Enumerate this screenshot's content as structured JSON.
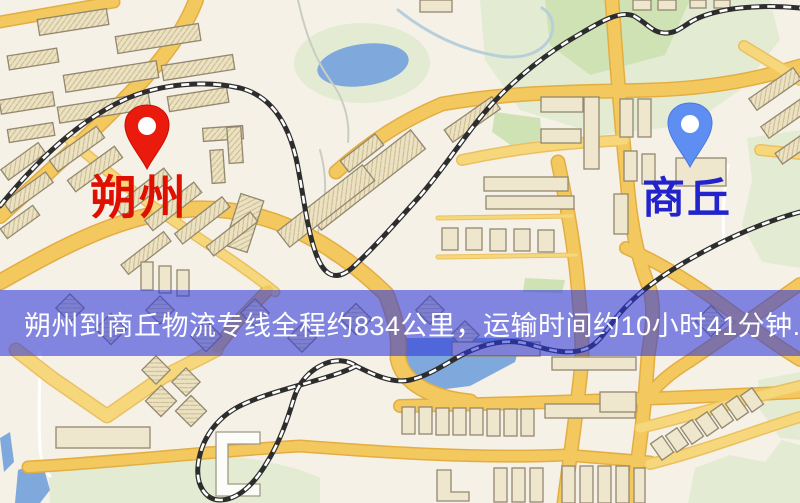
{
  "page": {
    "width": 800,
    "height": 503,
    "type": "logistics-route-map"
  },
  "markers": {
    "origin": {
      "label": "朔州",
      "text_color": "#e01000",
      "pin_color": "#ea1a0c"
    },
    "destination": {
      "label": "商丘",
      "text_color": "#2323cd",
      "pin_color": "#5e8ef2"
    }
  },
  "banner": {
    "text": "朔州到商丘物流专线全程约834公里，运输时间约10小时41分钟.",
    "background": "rgba(45,55,218,0.58)",
    "text_color": "#ffffff"
  },
  "route": {
    "from": "朔州",
    "to": "商丘",
    "distance": "约834公里",
    "duration": "约10小时41分钟"
  },
  "map_colors": {
    "background": "#f5f1e7",
    "road_major": "#f3c95f",
    "road_casing": "#e3ad42",
    "road_minor": "#f7d77c",
    "railway": "#2d2d2d",
    "park": "#e3ecd3",
    "park_dark": "#cfe2b4",
    "water": "#7fa9dc",
    "building_fill": "#efe7cd",
    "building_outline": "#93886f"
  }
}
